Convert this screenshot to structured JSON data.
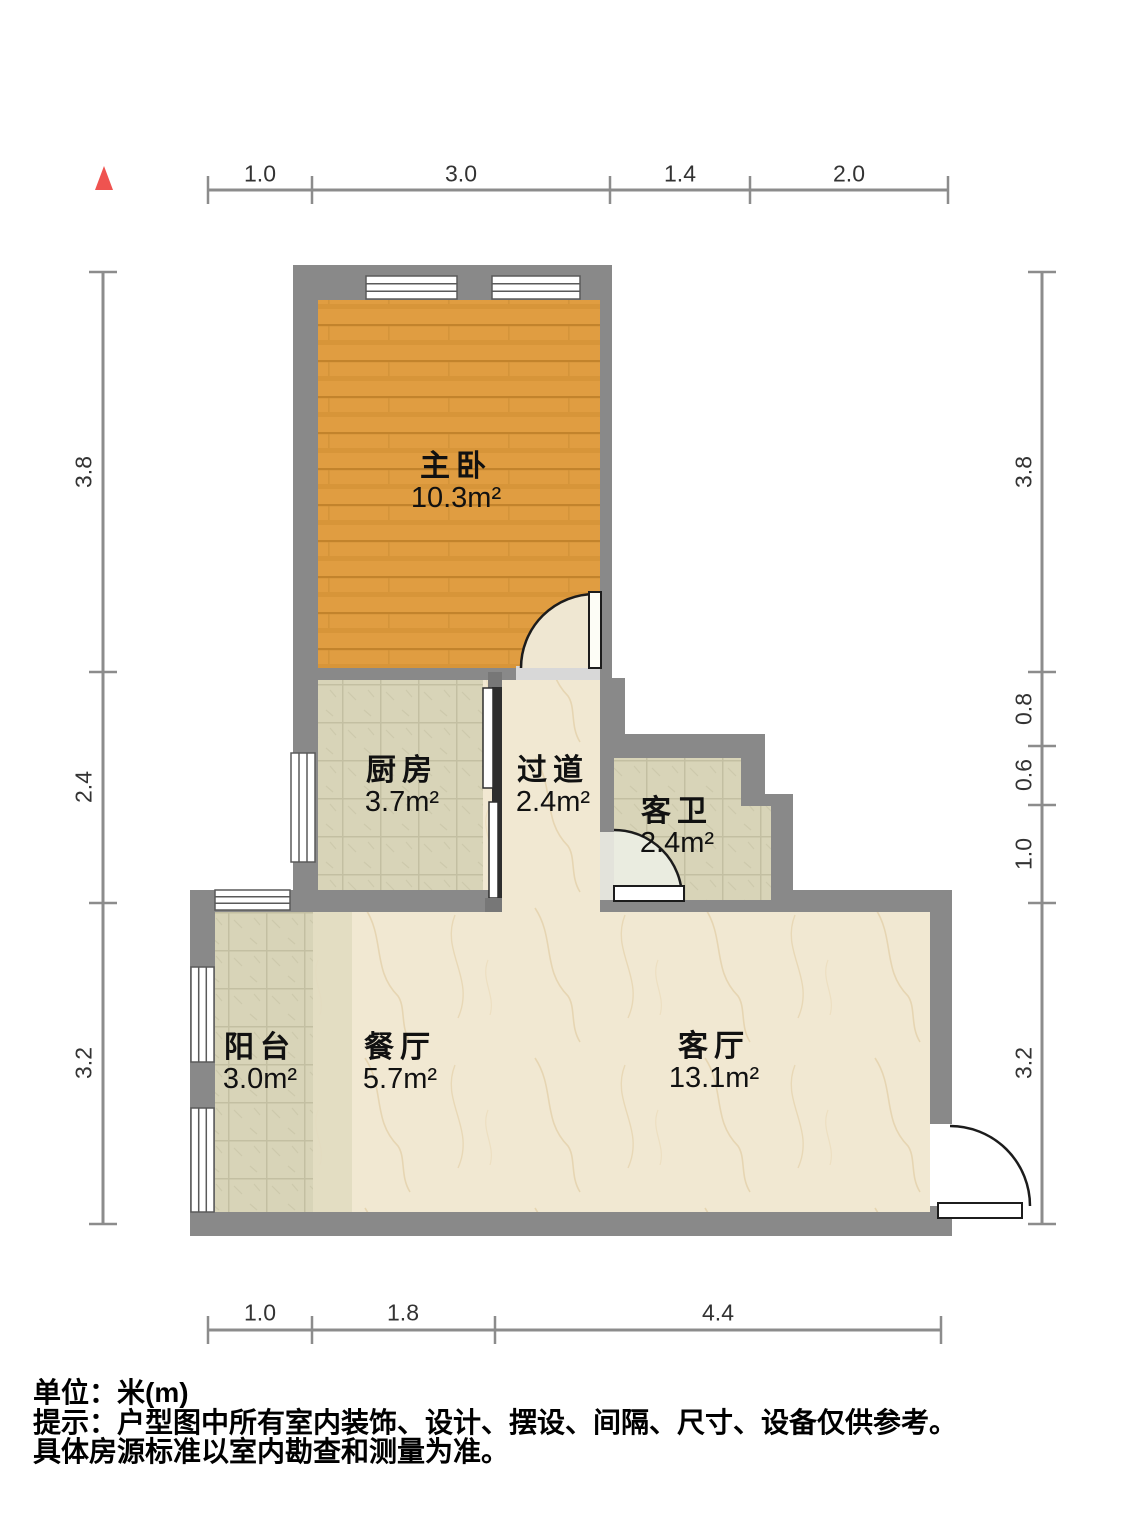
{
  "title": "户型图",
  "units": {
    "label": "单位：米(m)"
  },
  "footer": {
    "line1": "单位：米(m)",
    "line2": "提示：户型图中所有室内装饰、设计、摆设、间隔、尺寸、设备仅供参考。",
    "line3": "具体房源标准以室内勘查和测量为准。"
  },
  "compass": {
    "icon": "north-arrow-triangle",
    "color": "#ef5350"
  },
  "rooms": [
    {
      "id": "master-bedroom",
      "name": "主卧",
      "area": "10.3m²",
      "floor": "wood"
    },
    {
      "id": "kitchen",
      "name": "厨房",
      "area": "3.7m²",
      "floor": "tile"
    },
    {
      "id": "hallway",
      "name": "过道",
      "area": "2.4m²",
      "floor": "marble"
    },
    {
      "id": "guest-bathroom",
      "name": "客卫",
      "area": "2.4m²",
      "floor": "tile"
    },
    {
      "id": "balcony",
      "name": "阳台",
      "area": "3.0m²",
      "floor": "tile"
    },
    {
      "id": "dining-room",
      "name": "餐厅",
      "area": "5.7m²",
      "floor": "marble"
    },
    {
      "id": "living-room",
      "name": "客厅",
      "area": "13.1m²",
      "floor": "marble"
    }
  ],
  "dimensions": {
    "top": [
      "1.0",
      "3.0",
      "1.4",
      "2.0"
    ],
    "bottom": [
      "1.0",
      "1.8",
      "4.4"
    ],
    "left": [
      "3.8",
      "2.4",
      "3.2"
    ],
    "right": [
      "3.8",
      "0.8",
      "0.6",
      "1.0",
      "3.2"
    ]
  },
  "palette": {
    "wall": "#898989",
    "wood_floor": "#e09d41",
    "tile_floor": "#d8d4b8",
    "marble_floor": "#f1e8d2",
    "dimension_line": "#8c8c8c",
    "north_arrow": "#ef5350"
  }
}
